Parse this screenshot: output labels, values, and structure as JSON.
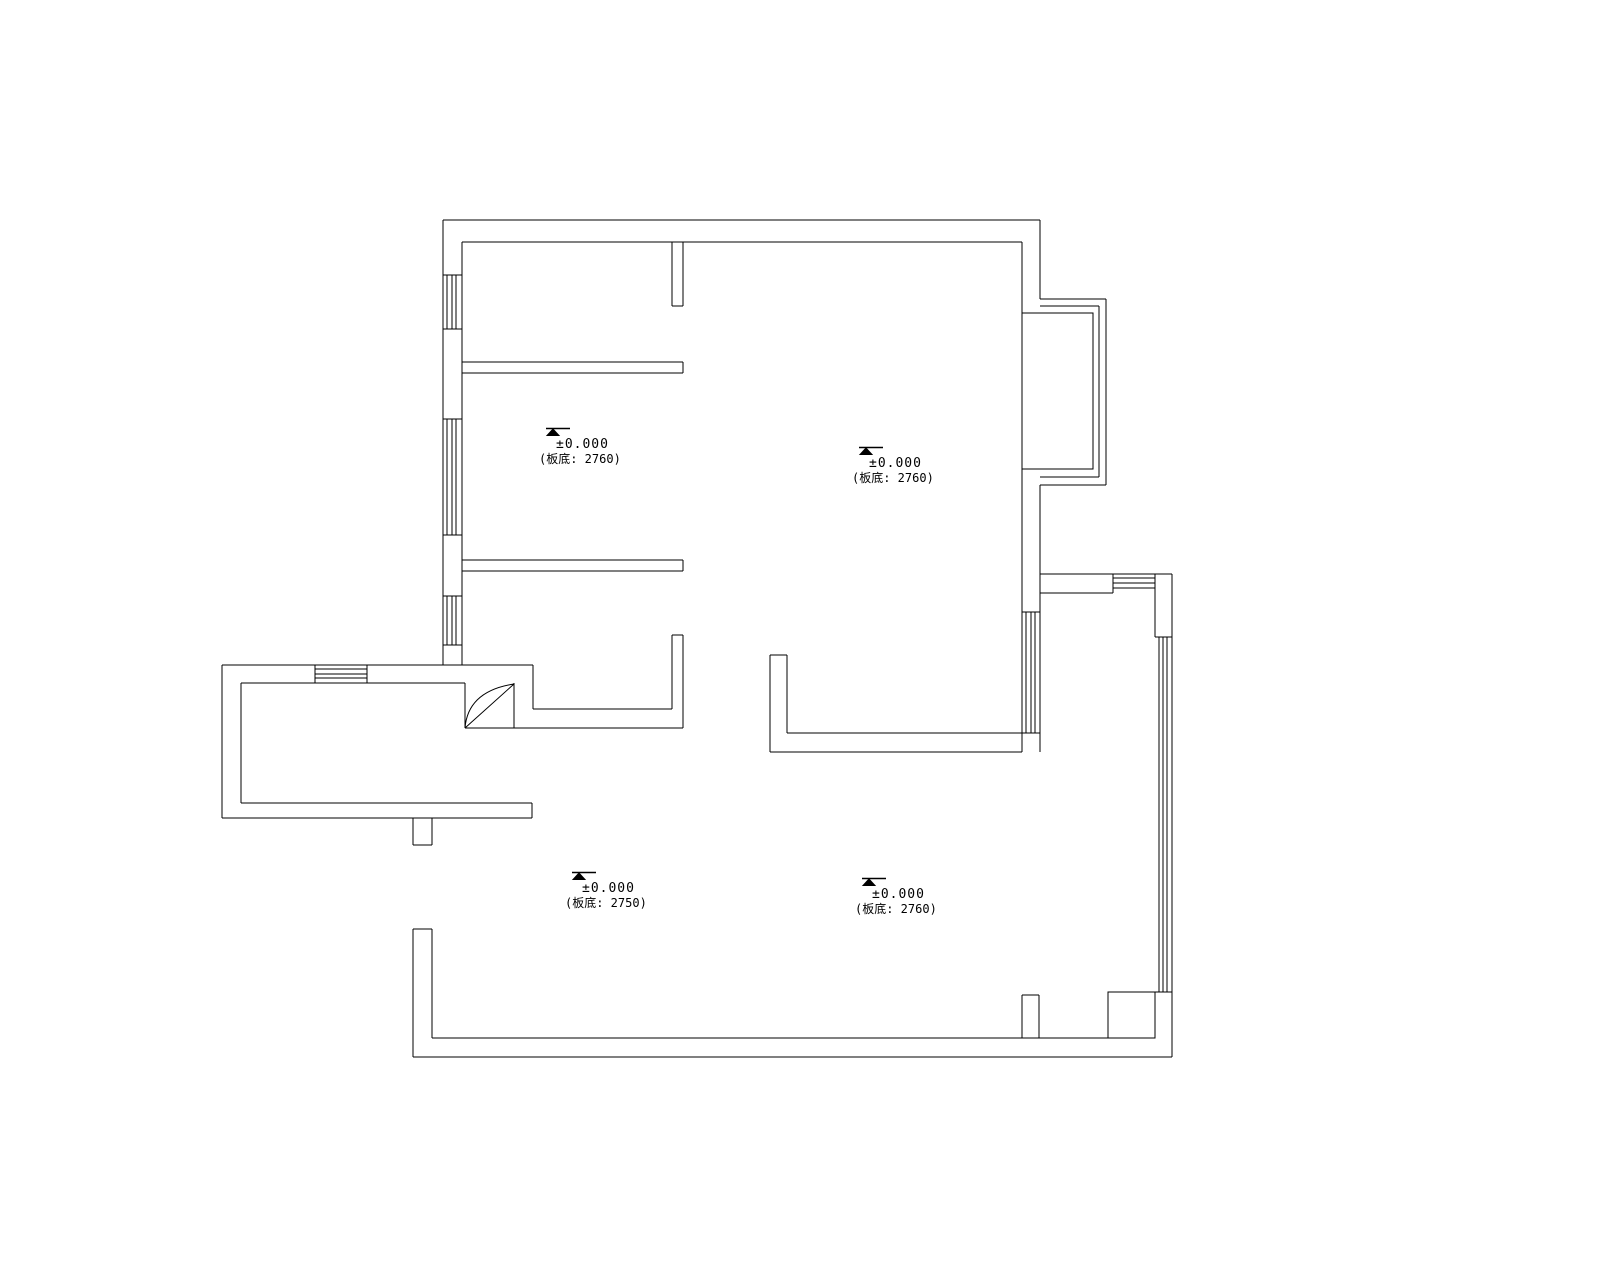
{
  "drawing": {
    "type": "floor-plan",
    "background_color": "#ffffff",
    "line_color": "#000000"
  },
  "markers": [
    {
      "elevation": "±0.000",
      "note": "(板底: 2760)"
    },
    {
      "elevation": "±0.000",
      "note": "(板底: 2760)"
    },
    {
      "elevation": "±0.000",
      "note": "(板底: 2750)"
    },
    {
      "elevation": "±0.000",
      "note": "(板底: 2760)"
    }
  ]
}
